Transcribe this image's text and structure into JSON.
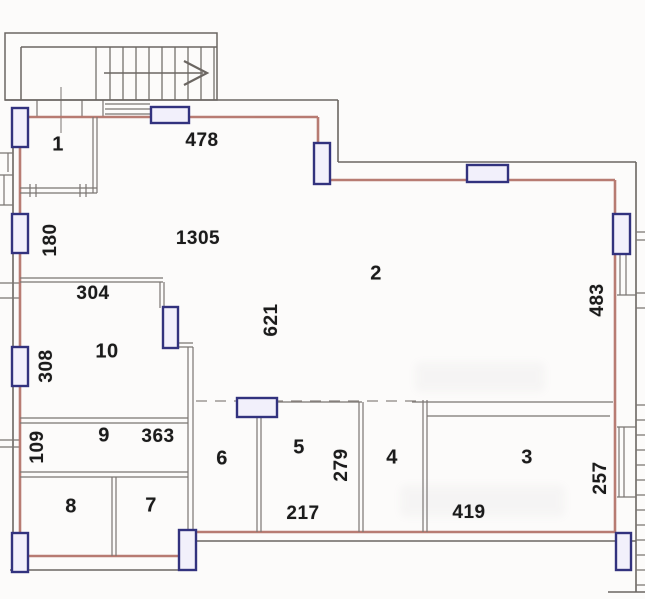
{
  "plan": {
    "kind": "apartment-floor-plan",
    "rooms": [
      {
        "number": "1"
      },
      {
        "number": "2"
      },
      {
        "number": "3"
      },
      {
        "number": "4"
      },
      {
        "number": "5"
      },
      {
        "number": "6"
      },
      {
        "number": "7"
      },
      {
        "number": "8"
      },
      {
        "number": "9"
      },
      {
        "number": "10"
      }
    ],
    "dims": {
      "top_width": "478",
      "hall_area": "1305",
      "left_upper": "180",
      "room10_width": "304",
      "hall_depth": "621",
      "left_mid": "308",
      "right_upper": "483",
      "left_lower": "109",
      "room9_width": "363",
      "room5_depth": "279",
      "room5_width": "217",
      "room3_width": "419",
      "right_lower": "257"
    },
    "colors": {
      "wall_accent": "#b4756b",
      "outline": "#6b6662",
      "interior_line": "#7a7572",
      "window_frame": "#32327e",
      "window_fill": "#f2f0fb",
      "label": "#1b1b1b",
      "background": "#fcfbfa"
    },
    "icons": {
      "stairs_direction_arrow": "arrow-right"
    }
  }
}
